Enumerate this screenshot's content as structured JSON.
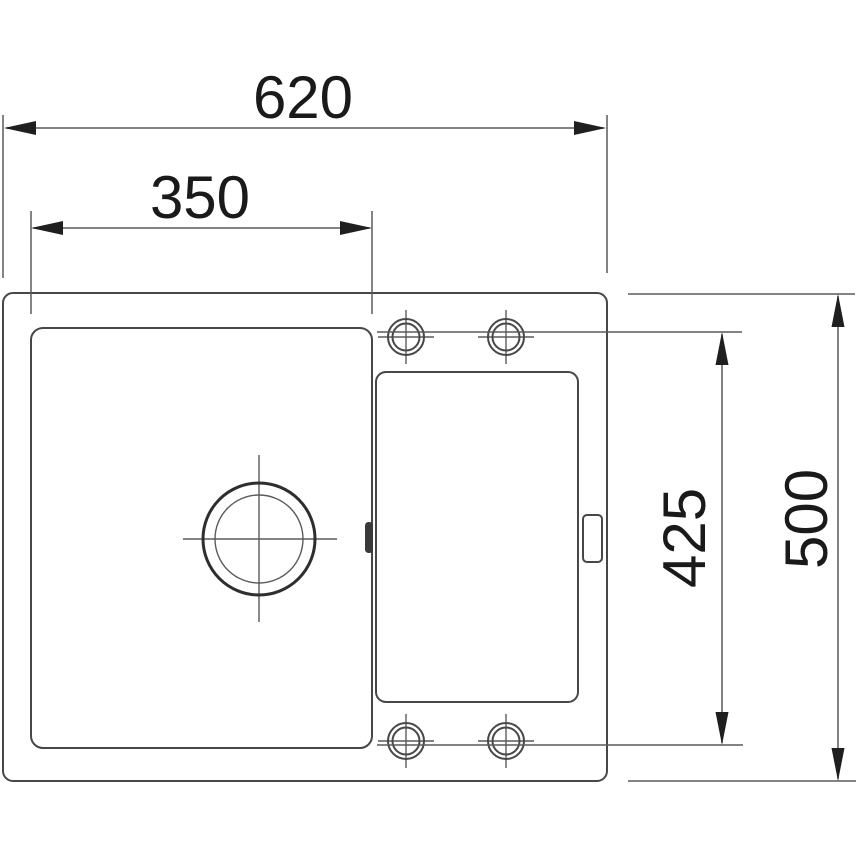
{
  "drawing": {
    "colors": {
      "background": "#ffffff",
      "outline": "#474747",
      "dimension_line": "#5a5a5a",
      "text": "#1a1a1a"
    },
    "dimensions": {
      "overall_width": "620",
      "bowl_width": "350",
      "inner_height": "425",
      "overall_height": "500"
    }
  }
}
